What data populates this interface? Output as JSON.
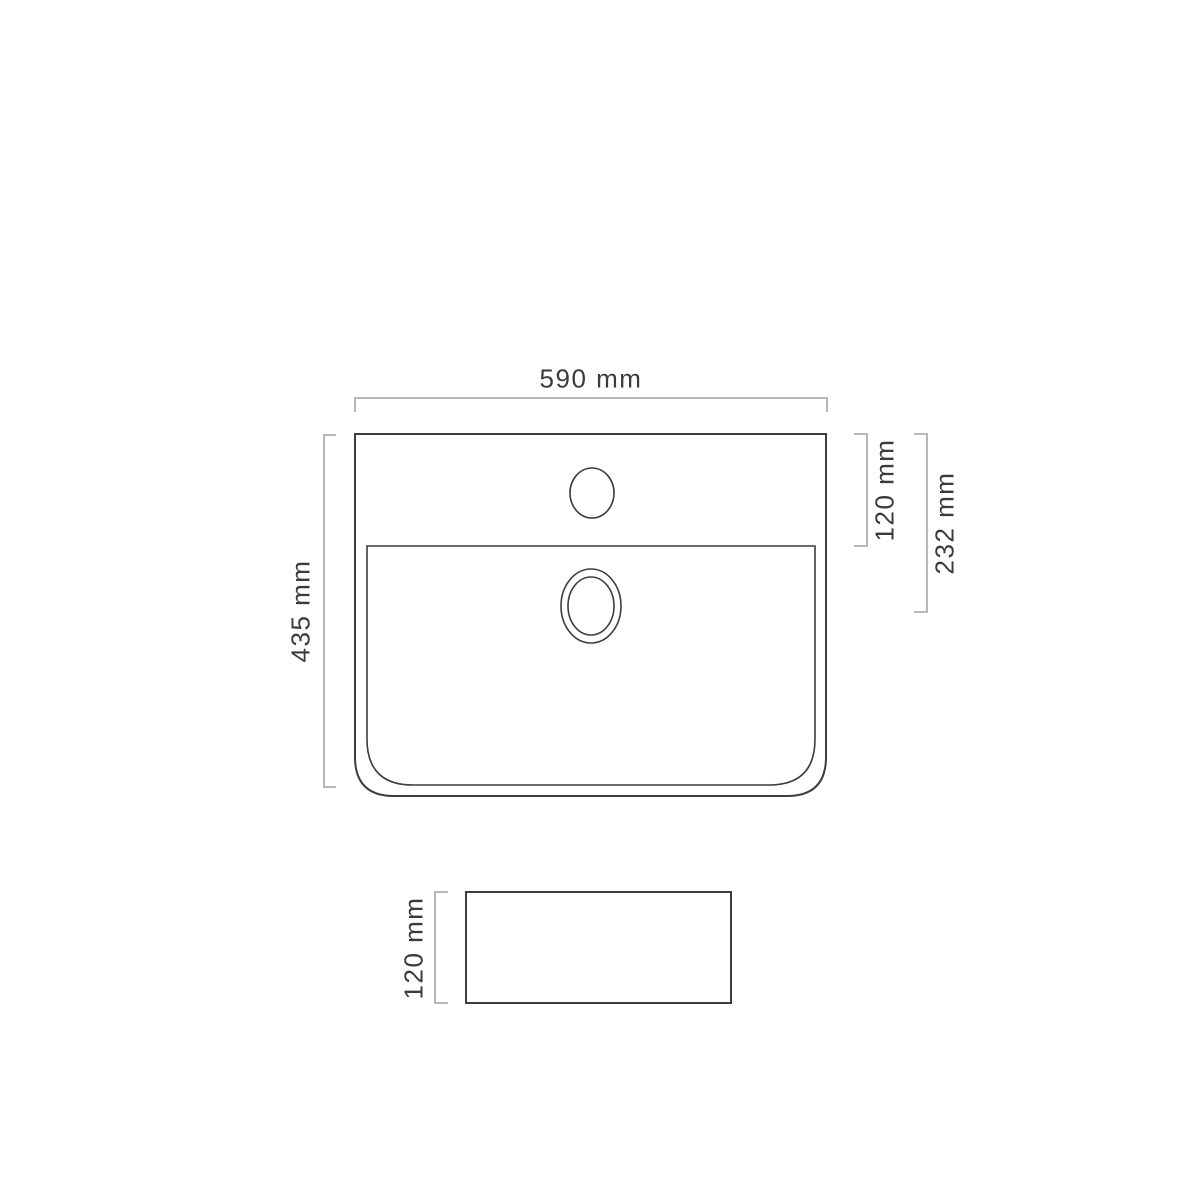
{
  "drawing": {
    "subject": "washbasin technical drawing",
    "top_view": {
      "width_label": "590 mm",
      "height_label": "435 mm",
      "ledge_depth_label": "120 mm",
      "drain_center_label": "232 mm"
    },
    "side_view": {
      "height_label": "120 mm"
    },
    "colors": {
      "outline": "#3d3d3d",
      "dimension": "#a3a3a3",
      "text": "#3b3b3b",
      "background": "#ffffff"
    }
  }
}
